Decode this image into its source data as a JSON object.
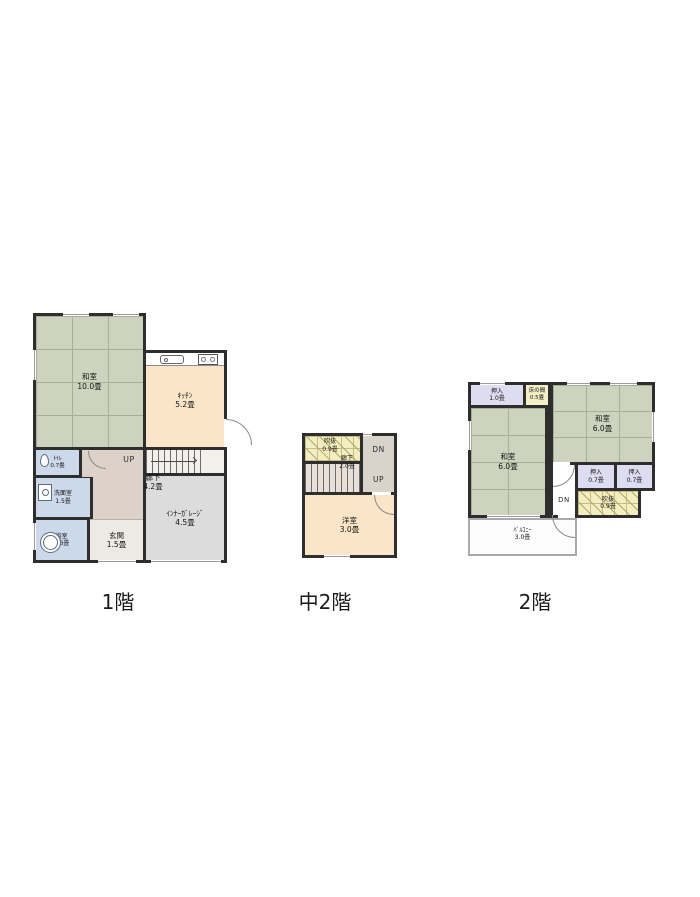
{
  "colors": {
    "wall": "#2e2e2e",
    "tatami": "#cdd3bf",
    "tatamiline": "#a6ae93",
    "kitchen": "#fbe5c8",
    "wet": "#cbd9ea",
    "hall": "#ddd2c9",
    "genkan": "#ede9e4",
    "garage": "#dcdcdc",
    "stairs1": "#f3f0ec",
    "stairs2": "#e8dfd8",
    "corridor2": "#d8d4cc",
    "closet": "#dedcf0",
    "tokonoma": "#f4efc6",
    "voidc": "#f3eec1",
    "voidline": "#b1a96a",
    "voidgrid": "#c4bd85",
    "balcony": "#a9a9a9",
    "tread": "#6b6b6b",
    "winline": "#9a9a9a",
    "arc": "#8a8a8a",
    "stepline": "#b9b0a8",
    "label": "#111111",
    "caption": "#1a1a1a"
  },
  "icons": {
    "sink": "sink-icon",
    "stove": "stove-icon",
    "toilet": "toilet-icon",
    "washbasin": "washbasin-icon",
    "bathtub": "bathtub-icon",
    "stairs_arrow": "stairs-direction-arrow-icon"
  },
  "floors": [
    {
      "caption": "1階",
      "rooms": {
        "washitsu": {
          "name": "和室",
          "size": "10.0畳"
        },
        "kitchen": {
          "name": "ｷｯﾁﾝ",
          "size": "5.2畳"
        },
        "toilet": {
          "name": "ﾄｲﾚ",
          "size": "0.7畳"
        },
        "washroom": {
          "name": "洗面室",
          "size": "1.5畳"
        },
        "bathroom": {
          "name": "浴室",
          "size": "1.6畳"
        },
        "entrance": {
          "name": "玄関",
          "size": "1.5畳"
        },
        "hallway": {
          "name": "廊下",
          "size": "4.2畳"
        },
        "garage": {
          "name": "ｲﾝﾅｰｶﾞﾚｰｼﾞ",
          "size": "4.5畳"
        }
      },
      "stairs": {
        "up": "UP"
      }
    },
    {
      "caption": "中2階",
      "rooms": {
        "void": {
          "name": "吹抜",
          "size": "0.9畳"
        },
        "hallway": {
          "name": "廊下",
          "size": "2.0畳"
        },
        "western_room": {
          "name": "洋室",
          "size": "3.0畳"
        }
      },
      "stairs": {
        "down": "DN",
        "up": "UP"
      }
    },
    {
      "caption": "2階",
      "rooms": {
        "closet_a": {
          "name": "押入",
          "size": "1.0畳"
        },
        "tokonoma": {
          "name": "床の間",
          "size": "0.5畳"
        },
        "washitsu_right": {
          "name": "和室",
          "size": "6.0畳"
        },
        "washitsu_left": {
          "name": "和室",
          "size": "6.0畳"
        },
        "closet_b": {
          "name": "押入",
          "size": "0.7畳"
        },
        "closet_c": {
          "name": "押入",
          "size": "0.7畳"
        },
        "void": {
          "name": "吹抜",
          "size": "0.9畳"
        },
        "balcony": {
          "name": "ﾊﾞﾙｺﾆｰ",
          "size": "3.0畳"
        }
      },
      "stairs": {
        "down": "DN"
      }
    }
  ]
}
